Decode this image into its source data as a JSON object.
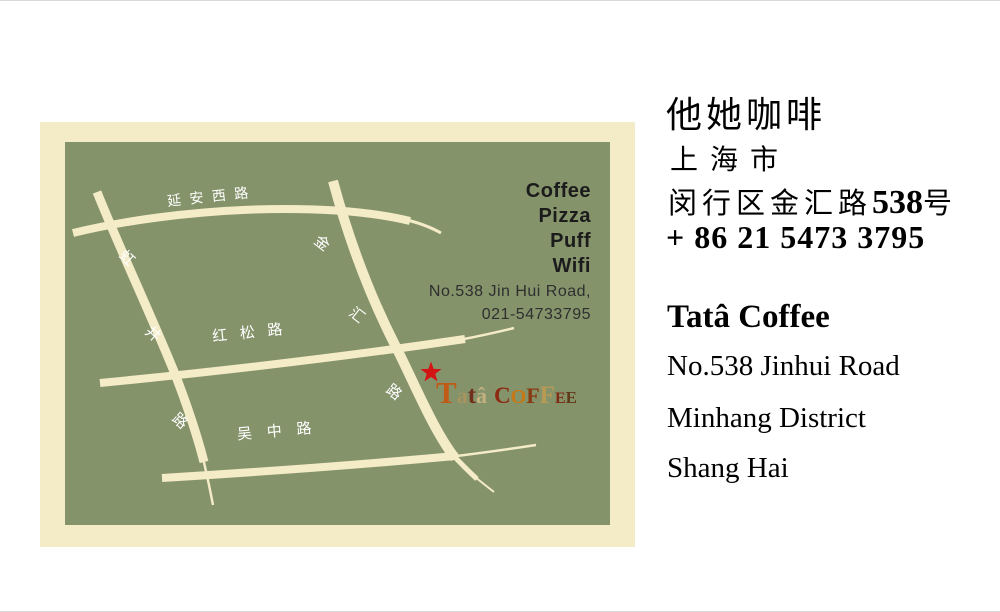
{
  "map_card": {
    "colors": {
      "card_bg": "#f4ebc7",
      "map_bg": "#85936b",
      "road": "#f4ebc7",
      "road_label": "#ffffff",
      "menu_text": "#1b1b1b",
      "address_text": "#2f2f2f",
      "star": "#d31414",
      "logo_palette": [
        "#c05a14",
        "#a9935f",
        "#6f2f1b",
        "#c2b07f",
        "#8c2a12",
        "#c87812",
        "#8a3a10",
        "#b89a55",
        "#7f2812",
        "#613a18"
      ]
    },
    "road_labels": {
      "yanan_west_road": "延 安 西 路",
      "hong": "虹",
      "jing": "井",
      "hongjing_lu": "路",
      "jin": "金",
      "hui": "汇",
      "jinhui_lu": "路",
      "hongsong_road": "红 松 路",
      "wuzhong_road": "吴 中 路"
    },
    "menu": {
      "items": [
        "Coffee",
        "Pizza",
        "Puff",
        "Wifi"
      ]
    },
    "address": {
      "line1": "No.538 Jin Hui Road,",
      "line2": "021-54733795"
    },
    "logo": {
      "letters": [
        "T",
        "a",
        "t",
        "â",
        "C",
        "O",
        "F",
        "F",
        "E",
        "E"
      ]
    }
  },
  "right_panel": {
    "zh": {
      "name": "他她咖啡",
      "city": "上海市",
      "address_prefix": "闵行区金汇路",
      "street_number": "538",
      "address_suffix": "号",
      "phone": "+ 86 21 5473 3795"
    },
    "en": {
      "name": "Tatâ Coffee",
      "address_line1": "No.538 Jinhui Road",
      "address_line2": "Minhang District",
      "address_line3": "Shang Hai"
    }
  }
}
